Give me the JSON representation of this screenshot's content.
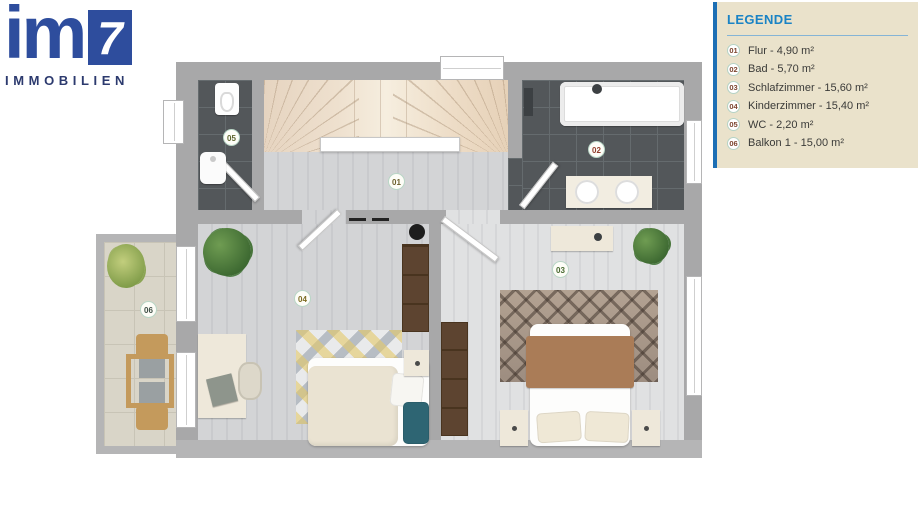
{
  "brand": {
    "logo_text": "im",
    "logo_number": "7",
    "logo_subtitle": "IMMOBILIEN",
    "brand_color": "#2e4d9d",
    "subtitle_color": "#2c3a6e"
  },
  "legend": {
    "title": "LEGENDE",
    "title_color": "#1a83c5",
    "accent_color": "#1d6fb5",
    "panel_bg": "#eae2cb",
    "items": [
      {
        "num": "01",
        "label": "Flur - 4,90 m²"
      },
      {
        "num": "02",
        "label": "Bad - 5,70 m²"
      },
      {
        "num": "03",
        "label": "Schlafzimmer - 15,60 m²"
      },
      {
        "num": "04",
        "label": "Kinderzimmer - 15,40 m²"
      },
      {
        "num": "05",
        "label": "WC - 2,20 m²"
      },
      {
        "num": "06",
        "label": "Balkon 1 - 15,00 m²"
      }
    ]
  },
  "plan": {
    "room_markers": [
      {
        "num": "01",
        "color": "#6b5f2c"
      },
      {
        "num": "02",
        "color": "#8f3b2a"
      },
      {
        "num": "03",
        "color": "#47682f"
      },
      {
        "num": "04",
        "color": "#7c6b21"
      },
      {
        "num": "05",
        "color": "#5c642b"
      },
      {
        "num": "06",
        "color": "#3f4f46"
      }
    ]
  }
}
